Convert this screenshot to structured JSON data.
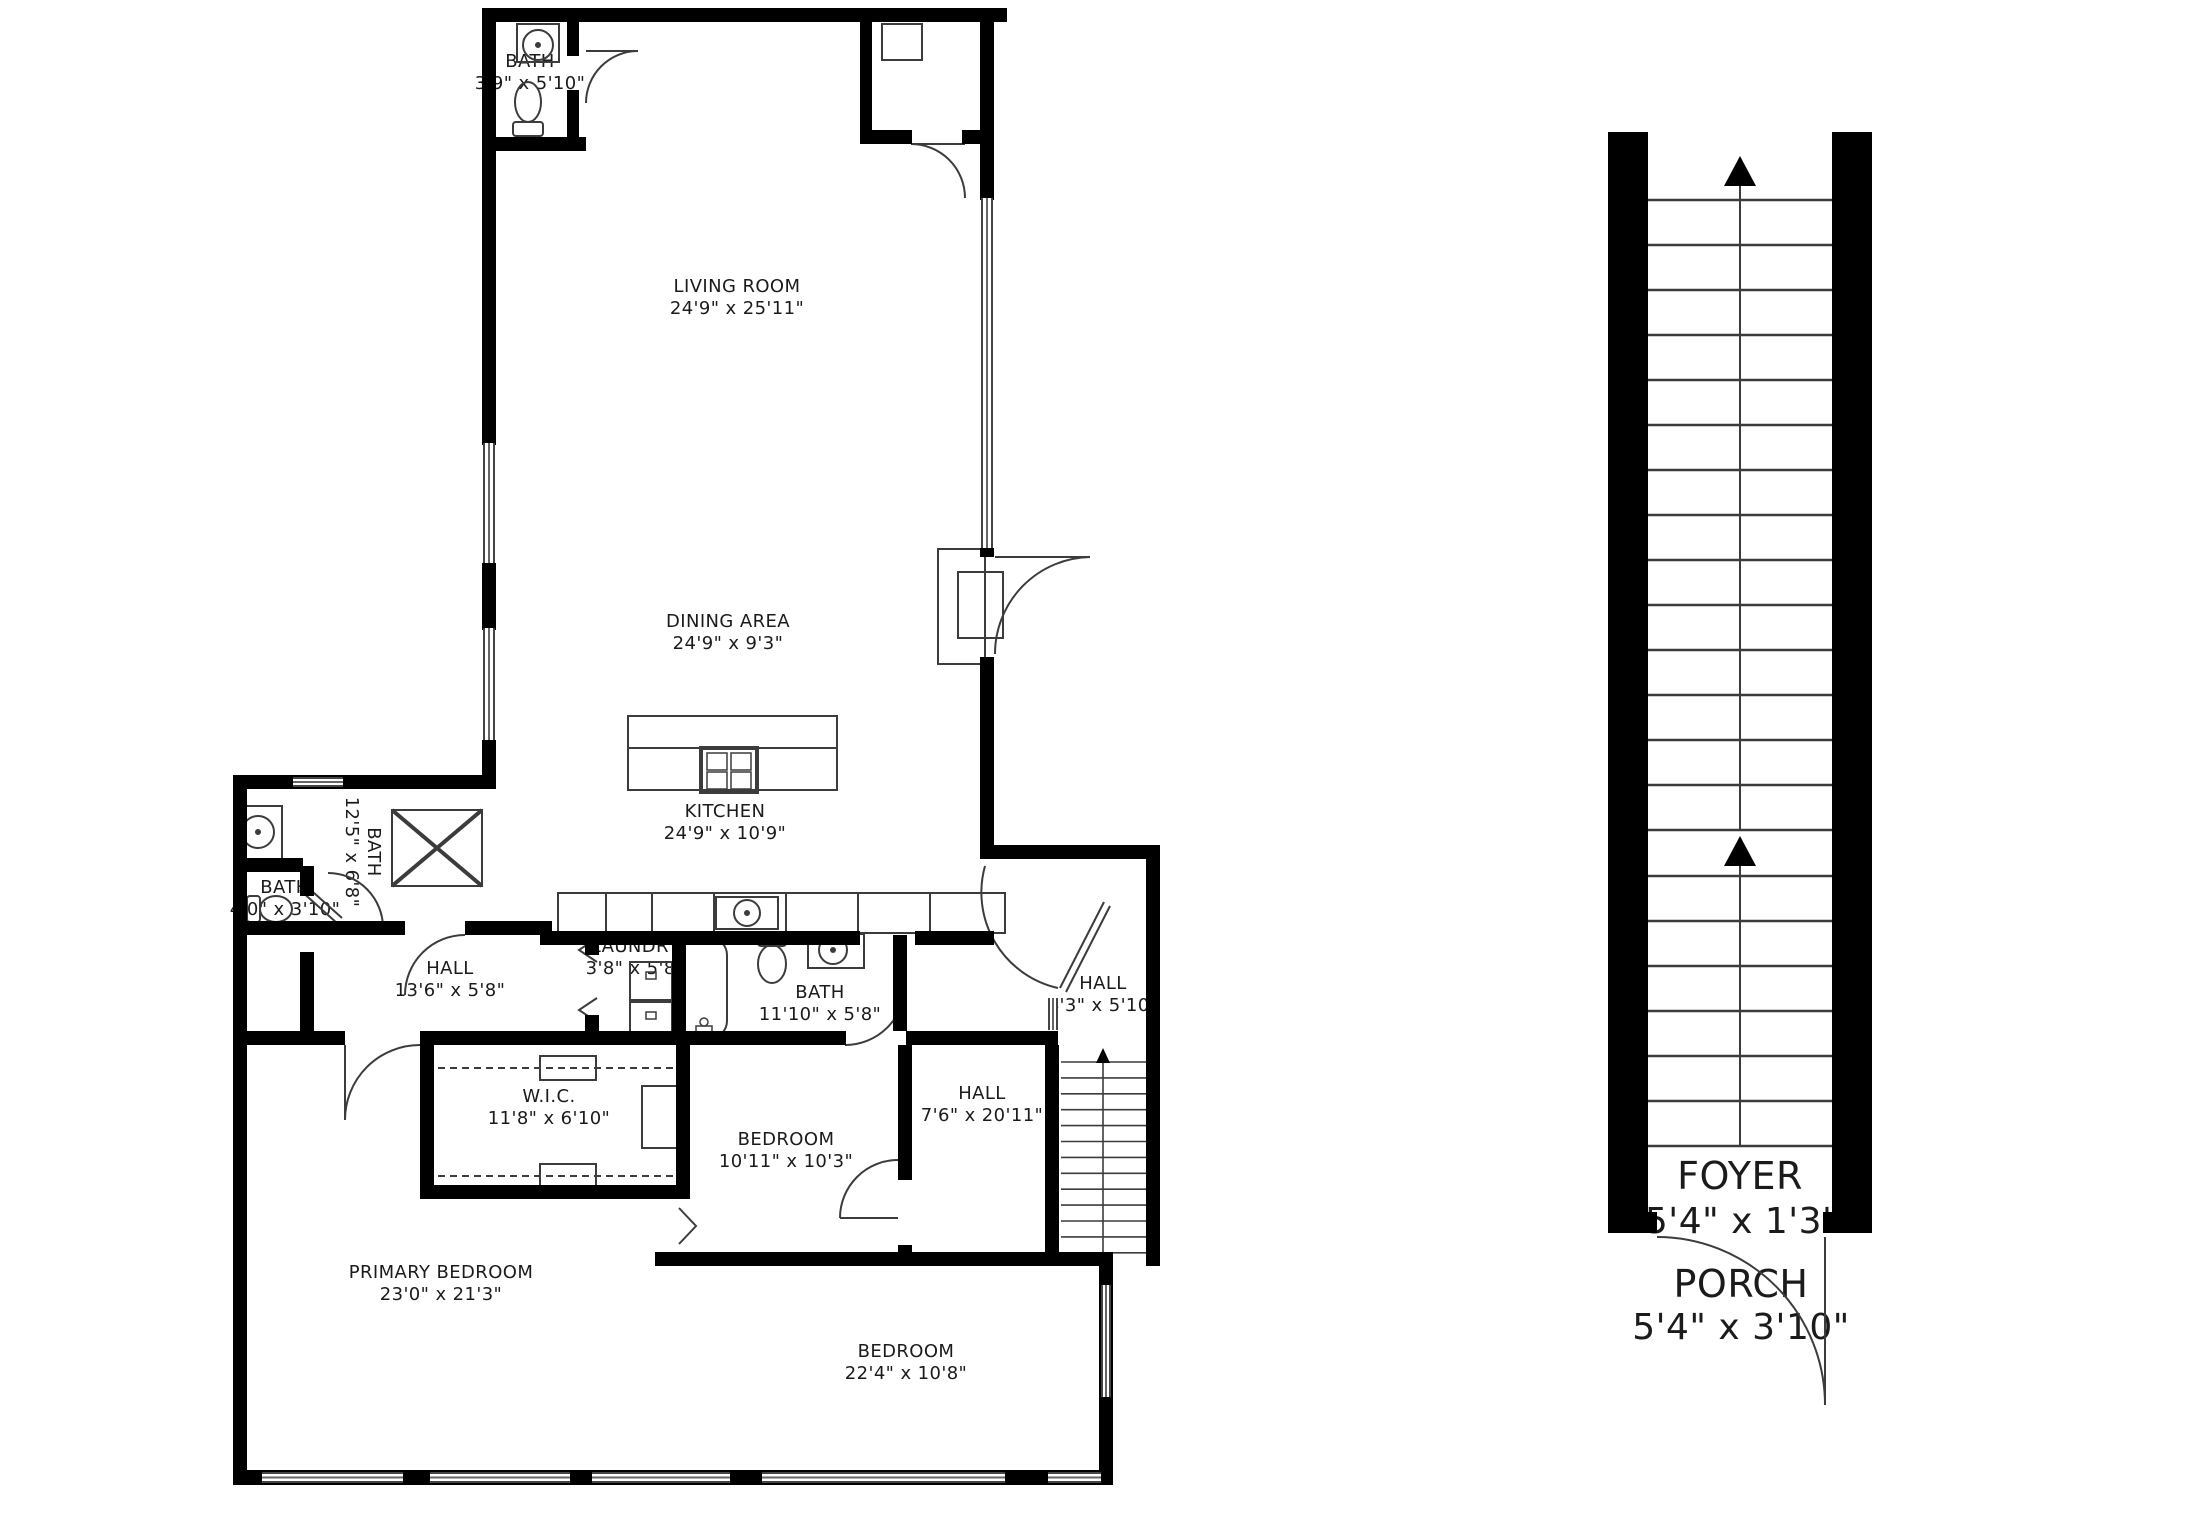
{
  "plan": {
    "title": "Floor plan",
    "rooms": {
      "bath_top": {
        "name": "BATH",
        "dims": "3'9\" x 5'10\""
      },
      "living": {
        "name": "LIVING ROOM",
        "dims": "24'9\" x 25'11\""
      },
      "dining": {
        "name": "DINING AREA",
        "dims": "24'9\" x 9'3\""
      },
      "kitchen": {
        "name": "KITCHEN",
        "dims": "24'9\" x 10'9\""
      },
      "bath_125": {
        "name": "BATH",
        "dims": "12'5\" x 6'8\""
      },
      "bath_40": {
        "name": "BATH",
        "dims": "4'0\" x 3'10\""
      },
      "laundry": {
        "name": "LAUNDRY",
        "dims": "3'8\" x 5'8\""
      },
      "hall_136": {
        "name": "HALL",
        "dims": "13'6\" x 5'8\""
      },
      "bath_1110": {
        "name": "BATH",
        "dims": "11'10\" x 5'8\""
      },
      "hall_43": {
        "name": "HALL",
        "dims": "4'3\" x 5'10\""
      },
      "wic": {
        "name": "W.I.C.",
        "dims": "11'8\" x 6'10\""
      },
      "bedroom_1011": {
        "name": "BEDROOM",
        "dims": "10'11\" x 10'3\""
      },
      "hall_76": {
        "name": "HALL",
        "dims": "7'6\" x 20'11\""
      },
      "primary": {
        "name": "PRIMARY BEDROOM",
        "dims": "23'0\" x 21'3\""
      },
      "bedroom_224": {
        "name": "BEDROOM",
        "dims": "22'4\" x 10'8\""
      },
      "foyer": {
        "name": "FOYER",
        "dims": "5'4\" x 1'3\""
      },
      "porch": {
        "name": "PORCH",
        "dims": "5'4\" x 3'10\""
      }
    },
    "colors": {
      "wall": "#000000",
      "line": "#3c3c3c",
      "text": "#1b1b1b"
    }
  }
}
